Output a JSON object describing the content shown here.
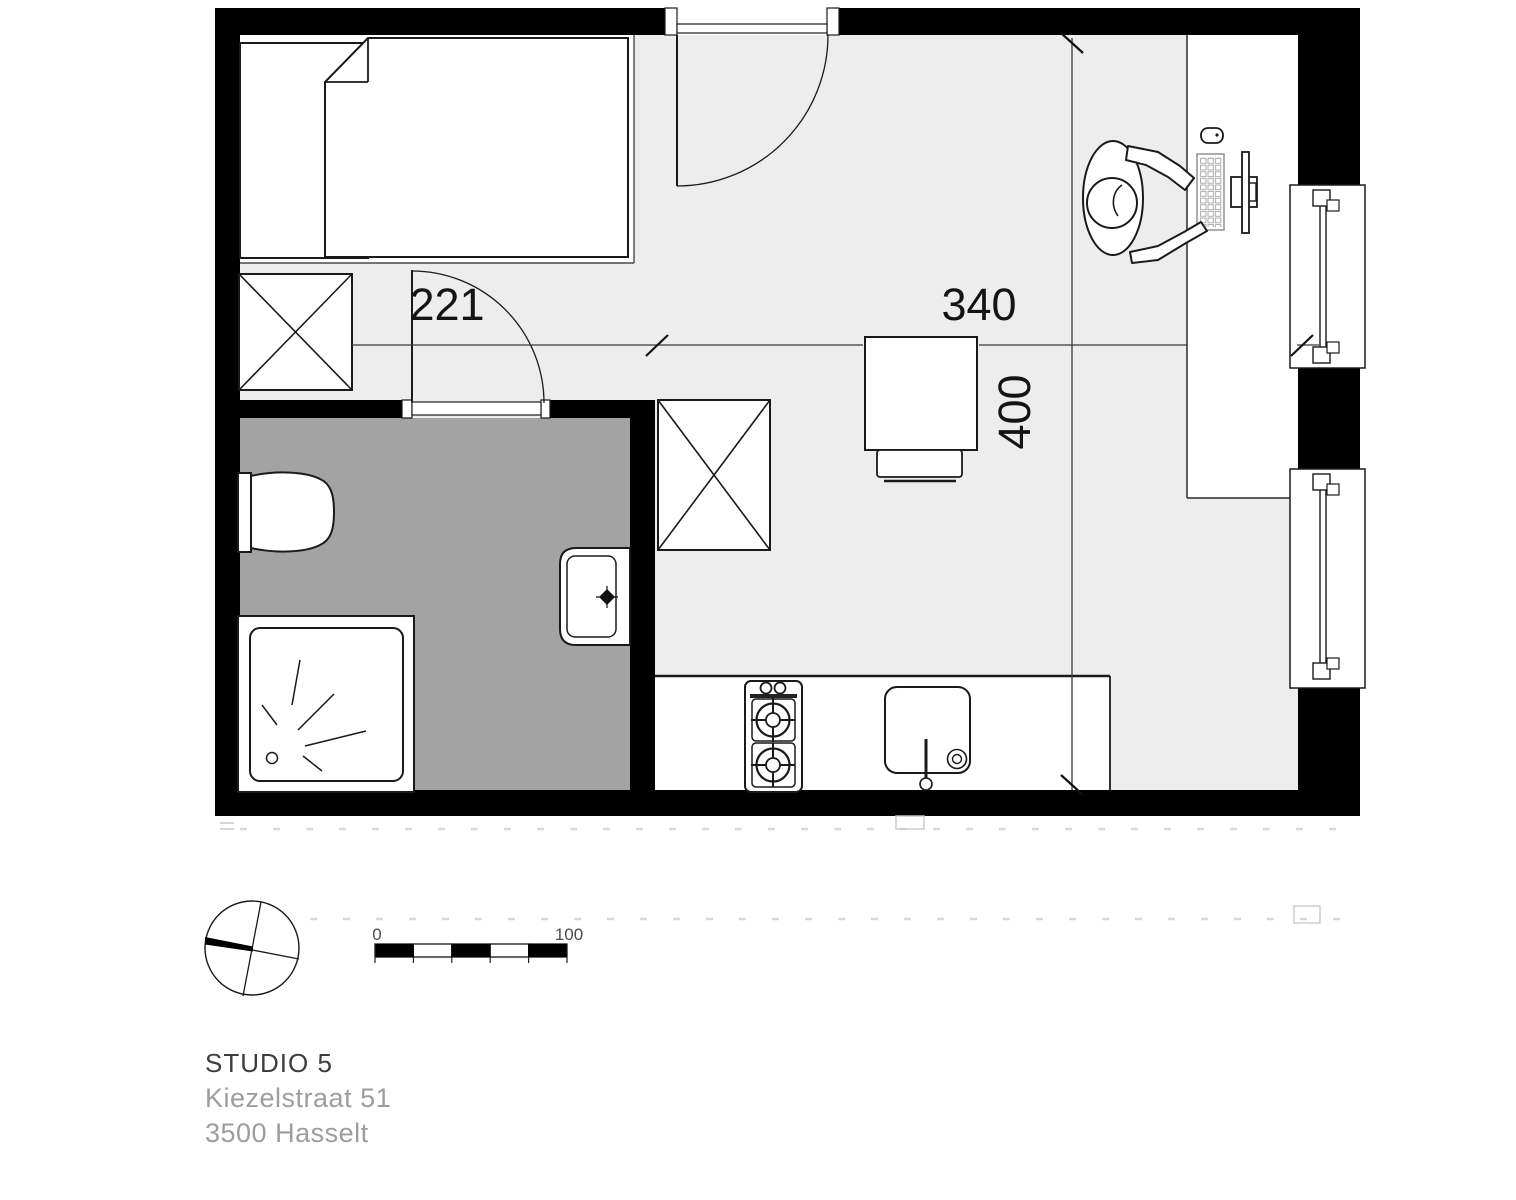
{
  "floorplan": {
    "dimensions": {
      "bathroom_width_cm": "221",
      "living_width_cm": "340",
      "living_depth_cm": "400"
    },
    "scale_bar": {
      "start_label": "0",
      "end_label": "100"
    },
    "symbols": [
      "bed",
      "wardrobe-cross-box",
      "entrance-door-swing",
      "bathroom-door-swing",
      "toilet",
      "shower",
      "washbasin",
      "kitchen-counter",
      "stove-two-burners",
      "kitchen-sink",
      "dining-table",
      "chair",
      "desk",
      "seated-person",
      "monitor",
      "keyboard",
      "mouse",
      "window",
      "north-arrow"
    ],
    "colors": {
      "wall": "#000000",
      "floor_main": "#ededed",
      "floor_bedroom": "#ffffff",
      "floor_bathroom": "#a3a3a3",
      "outline": "#1a1a1a",
      "page_background": "#ffffff"
    }
  },
  "footer": {
    "title": "STUDIO 5",
    "address_line_1": "Kiezelstraat 51",
    "address_line_2": "3500 Hasselt"
  }
}
